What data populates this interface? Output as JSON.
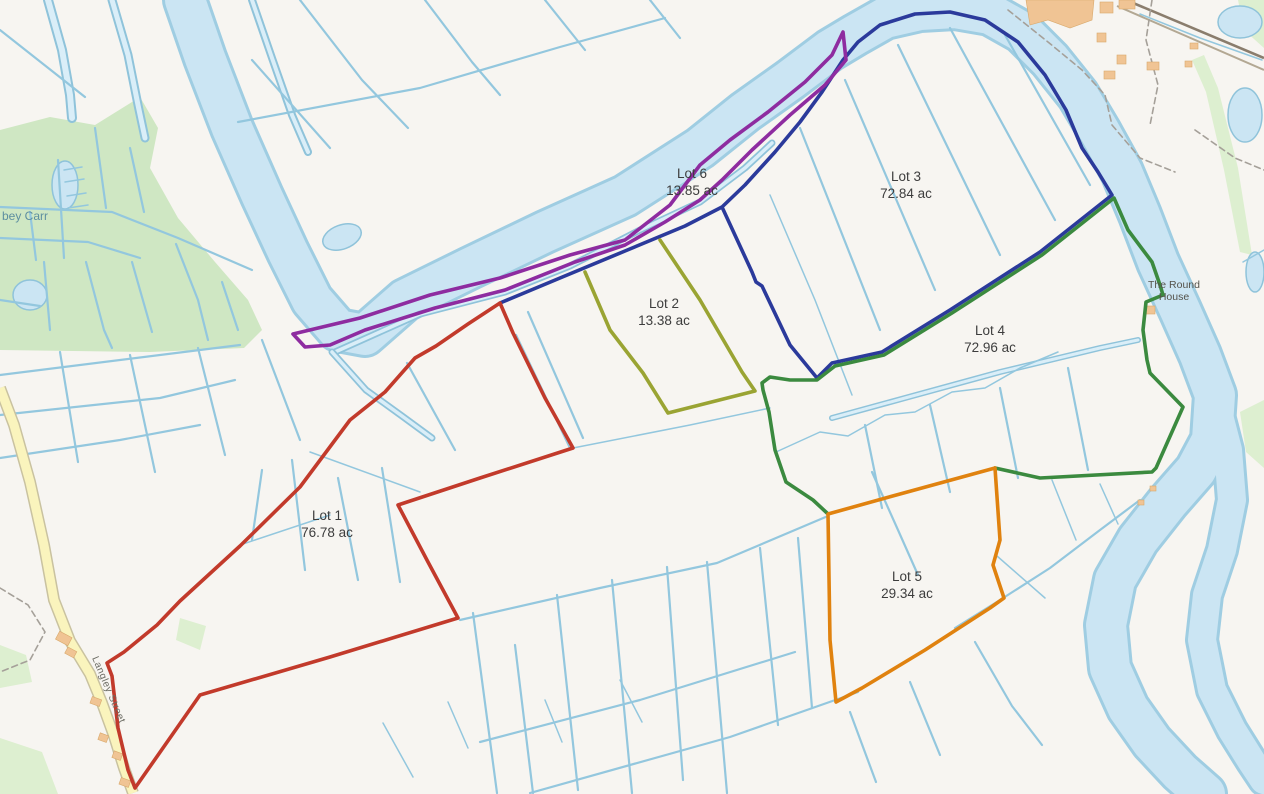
{
  "map": {
    "colors": {
      "background": "#f7f5f1",
      "water_fill": "#cbe5f3",
      "water_edge": "#9fcde2",
      "ditch": "#93c7de",
      "woodland": "#cfe7c3",
      "road_fill": "#faf4bd",
      "road_casing": "#c9c2a0",
      "building": "#f0c494",
      "railway": "#8a7d6d",
      "lot_label_text": "#3d3d3d"
    }
  },
  "lots": [
    {
      "name": "Lot 1",
      "area": "76.78 ac",
      "color": "#c23a2b"
    },
    {
      "name": "Lot 2",
      "area": "13.38 ac",
      "color": "#9aa433"
    },
    {
      "name": "Lot 3",
      "area": "72.84 ac",
      "color": "#2b3a9b"
    },
    {
      "name": "Lot 4",
      "area": "72.96 ac",
      "color": "#3b8a3f"
    },
    {
      "name": "Lot 5",
      "area": "29.34 ac",
      "color": "#e0820f"
    },
    {
      "name": "Lot 6",
      "area": "13.85 ac",
      "color": "#8e2ca0"
    }
  ],
  "places": {
    "woodland": "bey Carr",
    "round_house_line1": "The Round",
    "round_house_line2": "House",
    "street": "Langley Street"
  }
}
